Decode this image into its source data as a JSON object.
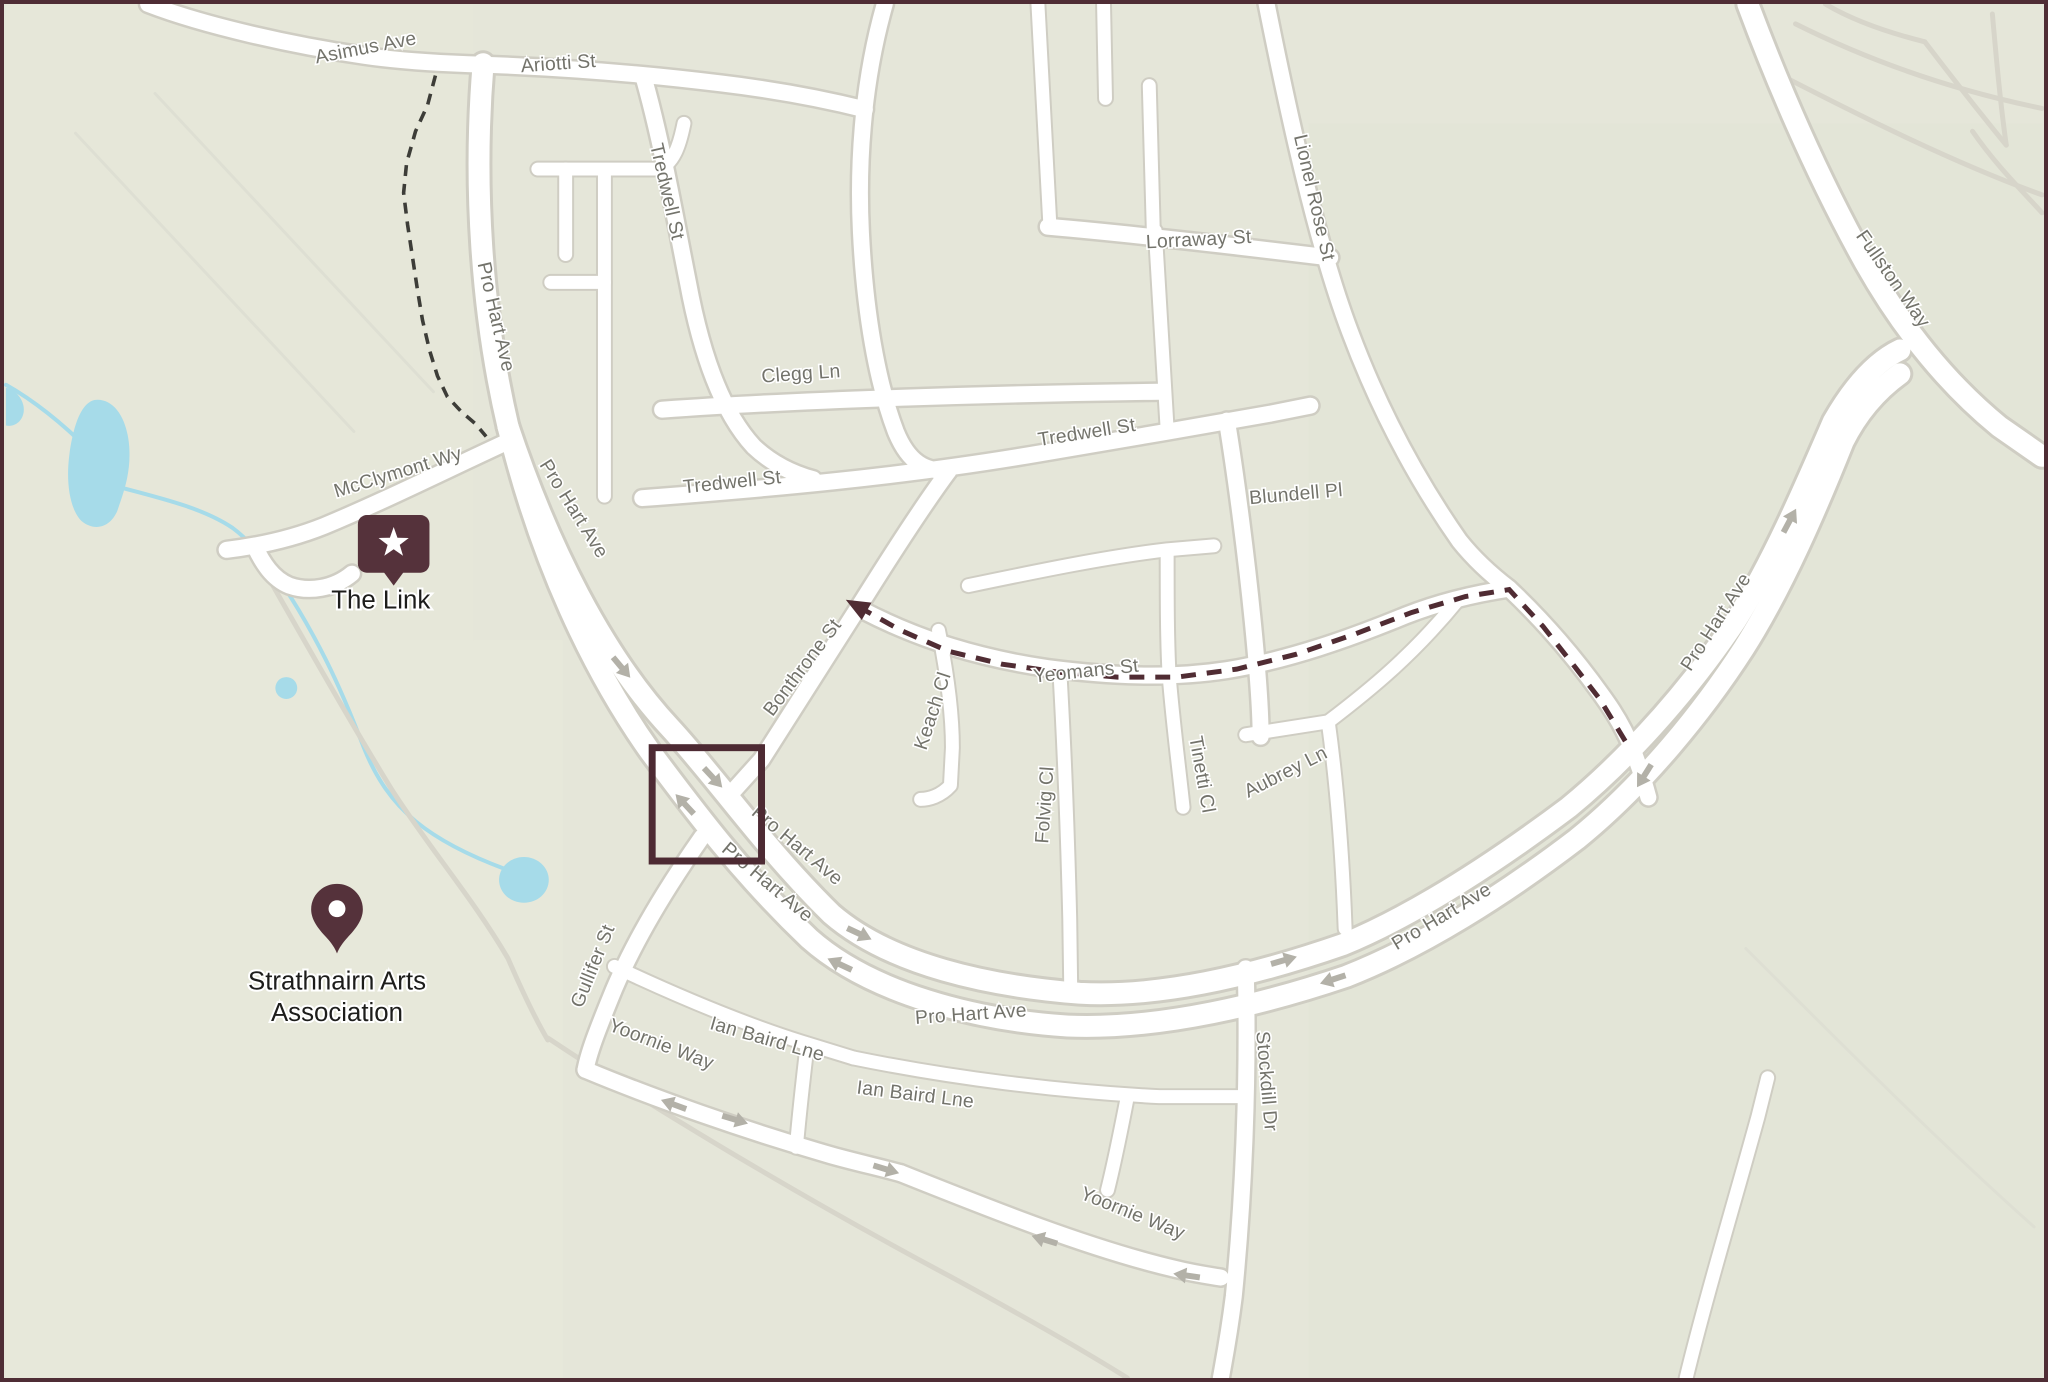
{
  "map": {
    "colors": {
      "background": "#e5e6d9",
      "road_fill": "#ffffff",
      "road_casing": "#cfcdc3",
      "foot_path": "#d7d5ca",
      "water": "#a6dbe9",
      "frame_border": "#4f2d35",
      "viewport_square": "#4d2a33",
      "route_dashed": "#502c33",
      "walking_path_dashed": "#3d3d38",
      "oneway_arrow": "#b3b1a8",
      "street_label": "#73736b",
      "poi_label": "#1d1d1b",
      "poi_marker": "#55323b"
    },
    "streets": [
      {
        "name": "Asimus Ave",
        "x": 363,
        "y": 50,
        "rot": -11
      },
      {
        "name": "Ariotti St",
        "x": 556,
        "y": 66,
        "rot": -4
      },
      {
        "name": "Tredwell St",
        "x": 659,
        "y": 190,
        "rot": 77
      },
      {
        "name": "Clegg Ln",
        "x": 800,
        "y": 378,
        "rot": -4
      },
      {
        "name": "Tredwell St",
        "x": 731,
        "y": 487,
        "rot": -6
      },
      {
        "name": "Tredwell St",
        "x": 1088,
        "y": 437,
        "rot": -9
      },
      {
        "name": "Lorraway St",
        "x": 1200,
        "y": 243,
        "rot": -3
      },
      {
        "name": "Lionel Rose St",
        "x": 1310,
        "y": 196,
        "rot": 77
      },
      {
        "name": "Blundell Pl",
        "x": 1298,
        "y": 499,
        "rot": -5
      },
      {
        "name": "Bonthrone St",
        "x": 806,
        "y": 671,
        "rot": -53
      },
      {
        "name": "Yeomans St",
        "x": 1087,
        "y": 677,
        "rot": -6
      },
      {
        "name": "Keach Cl",
        "x": 938,
        "y": 713,
        "rot": -72
      },
      {
        "name": "Folvig Cl",
        "x": 1051,
        "y": 806,
        "rot": -86
      },
      {
        "name": "Tinetti Cl",
        "x": 1197,
        "y": 776,
        "rot": 80
      },
      {
        "name": "Aubrey Ln",
        "x": 1290,
        "y": 778,
        "rot": -27
      },
      {
        "name": "McClymont Wy",
        "x": 396,
        "y": 477,
        "rot": -17
      },
      {
        "name": "Pro Hart Ave",
        "x": 487,
        "y": 316,
        "rot": 77
      },
      {
        "name": "Pro Hart Ave",
        "x": 566,
        "y": 511,
        "rot": 58
      },
      {
        "name": "Pro Hart Ave",
        "x": 792,
        "y": 851,
        "rot": 40
      },
      {
        "name": "Pro Hart Ave",
        "x": 762,
        "y": 888,
        "rot": 40
      },
      {
        "name": "Pro Hart Ave",
        "x": 971,
        "y": 1022,
        "rot": -4
      },
      {
        "name": "Pro Hart Ave",
        "x": 1447,
        "y": 923,
        "rot": -31
      },
      {
        "name": "Pro Hart Ave",
        "x": 1725,
        "y": 625,
        "rot": -57
      },
      {
        "name": "Fullston Way",
        "x": 1893,
        "y": 280,
        "rot": 55
      },
      {
        "name": "Stockdill Dr",
        "x": 1262,
        "y": 1084,
        "rot": 85
      },
      {
        "name": "Gullifer St",
        "x": 596,
        "y": 970,
        "rot": -68
      },
      {
        "name": "Yoornie Way",
        "x": 657,
        "y": 1052,
        "rot": 21
      },
      {
        "name": "Yoornie Way",
        "x": 1131,
        "y": 1222,
        "rot": 22
      },
      {
        "name": "Ian Baird Lne",
        "x": 764,
        "y": 1047,
        "rot": 16
      },
      {
        "name": "Ian Baird Lne",
        "x": 914,
        "y": 1103,
        "rot": 7
      }
    ],
    "pois": [
      {
        "id": "the-link",
        "name": "The Link",
        "marker": "star-badge",
        "x": 390,
        "y": 543,
        "label_lines": [
          "The Link"
        ],
        "label_x": 377,
        "label_y": 608
      },
      {
        "id": "strathnairn-arts-association",
        "name": "Strathnairn Arts Association",
        "marker": "pin",
        "x": 333,
        "y": 911,
        "label_lines": [
          "Strathnairn Arts",
          "Association"
        ],
        "label_x": 333,
        "label_y": 991
      }
    ],
    "routes": {
      "walking_path_nw": {
        "style": "walking_path_dashed",
        "points": [
          [
            432,
            72
          ],
          [
            424,
            102
          ],
          [
            412,
            128
          ],
          [
            403,
            160
          ],
          [
            400,
            190
          ],
          [
            404,
            222
          ],
          [
            409,
            255
          ],
          [
            414,
            288
          ],
          [
            419,
            318
          ],
          [
            426,
            348
          ],
          [
            434,
            374
          ],
          [
            444,
            395
          ],
          [
            458,
            410
          ],
          [
            472,
            422
          ],
          [
            483,
            435
          ]
        ]
      },
      "highlighted_route": {
        "style": "route_dashed",
        "arrow_at_start": true,
        "points": [
          [
            857,
            606
          ],
          [
            900,
            630
          ],
          [
            948,
            651
          ],
          [
            1002,
            664
          ],
          [
            1058,
            672
          ],
          [
            1118,
            677
          ],
          [
            1178,
            677
          ],
          [
            1238,
            669
          ],
          [
            1298,
            654
          ],
          [
            1356,
            634
          ],
          [
            1414,
            612
          ],
          [
            1468,
            596
          ],
          [
            1512,
            589
          ],
          [
            1546,
            626
          ],
          [
            1576,
            664
          ],
          [
            1603,
            699
          ],
          [
            1634,
            750
          ]
        ]
      }
    },
    "oneway_arrows": [
      {
        "x": 619,
        "y": 667,
        "rot": 50
      },
      {
        "x": 711,
        "y": 778,
        "rot": 47
      },
      {
        "x": 683,
        "y": 805,
        "rot": 227
      },
      {
        "x": 858,
        "y": 935,
        "rot": 25
      },
      {
        "x": 839,
        "y": 966,
        "rot": 205
      },
      {
        "x": 1285,
        "y": 962,
        "rot": -16
      },
      {
        "x": 1335,
        "y": 981,
        "rot": 162
      },
      {
        "x": 1794,
        "y": 520,
        "rot": -62
      },
      {
        "x": 1648,
        "y": 776,
        "rot": 122
      },
      {
        "x": 672,
        "y": 1107,
        "rot": 200
      },
      {
        "x": 733,
        "y": 1122,
        "rot": 17
      },
      {
        "x": 885,
        "y": 1172,
        "rot": 17
      },
      {
        "x": 1045,
        "y": 1243,
        "rot": 197
      },
      {
        "x": 1188,
        "y": 1279,
        "rot": 188
      }
    ],
    "viewport_square": {
      "x": 650,
      "y": 748,
      "w": 110,
      "h": 114
    }
  }
}
